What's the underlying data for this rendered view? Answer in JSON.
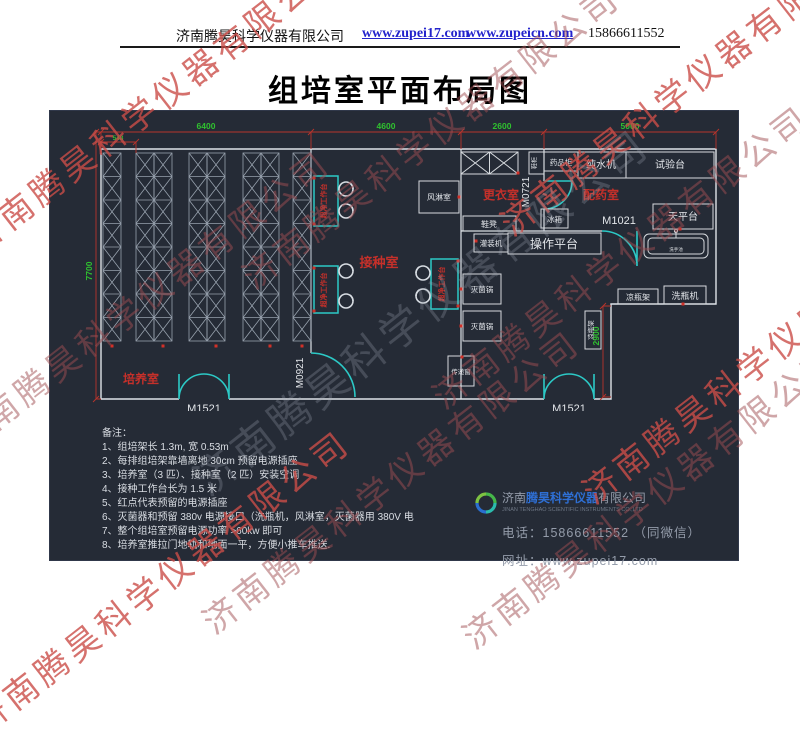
{
  "header": {
    "company": "济南腾昊科学仪器有限公司",
    "link1": "www.zupei17.com",
    "link2": "www.zupeicn.com",
    "phone": "15866611552"
  },
  "title": "组培室平面布局图",
  "watermark": {
    "text": "济南腾昊科学仪器有限公司"
  },
  "plan": {
    "dimensions": {
      "top": [
        "6400",
        "4600",
        "2600",
        "5000"
      ],
      "small": "548",
      "left": "7700",
      "right": "2900"
    },
    "rooms": {
      "culture": "培养室",
      "inoculation": "接种室",
      "changing": "更衣室",
      "dispensing": "配药室"
    },
    "doors": {
      "m1521": "M1521",
      "m0921": "M0921",
      "m0721": "M0721",
      "m1021": "M1021"
    },
    "equipment": {
      "clean_bench": "超净工作台",
      "air_shower": "风淋室",
      "wardrobe_cabinet": "药品柜",
      "shoe_cabinet": "鞋柜",
      "pure_water": "纯水机",
      "test_bench": "试验台",
      "balance_table": "天平台",
      "sink": "洗手池",
      "fridge": "冰箱",
      "shoe_bench": "鞋凳",
      "filling_machine": "灌装机",
      "operation_platform": "操作平台",
      "sterilizer": "灭菌锅",
      "pass_window": "传递窗",
      "bottle_rack": "凉瓶架",
      "bottle_washer": "洗瓶机"
    }
  },
  "notes": {
    "title": "备注：",
    "items": [
      "1、组培架长 1.3m, 宽 0.53m",
      "2、每排组培架靠墙离地 30cm 预留电源插座",
      "3、培养室（3 匹）、接种室（2 匹）安装空调",
      "4、接种工作台长为 1.5 米",
      "5、红点代表预留的电源插座",
      "6、灭菌器和预留 380v 电源接口（洗瓶机，风淋室，灭菌器用 380V 电",
      "7、整个组培室预留电源功率 >60kw 即可",
      "8、培养室推拉门地轨和地面一平，方便小推车推送."
    ]
  },
  "footer": {
    "company_prefix": "济南",
    "company_brand": "腾昊科学仪器",
    "company_suffix": "有限公司",
    "company_en": "JINAN TENGHAO SCIENTIFIC INSTRUMENTS CO.,LTD",
    "phone_label": "电话：",
    "phone": "15866611552 （同微信）",
    "web_label": "网址：",
    "web": "www.zupei17.com"
  },
  "colors": {
    "panel_bg": "#252b36",
    "teal": "#2cc9c6",
    "dim_red": "#b8342c",
    "dim_green": "#2fc12f",
    "room_red": "#c5302a",
    "line_white": "#dfe3e8"
  }
}
